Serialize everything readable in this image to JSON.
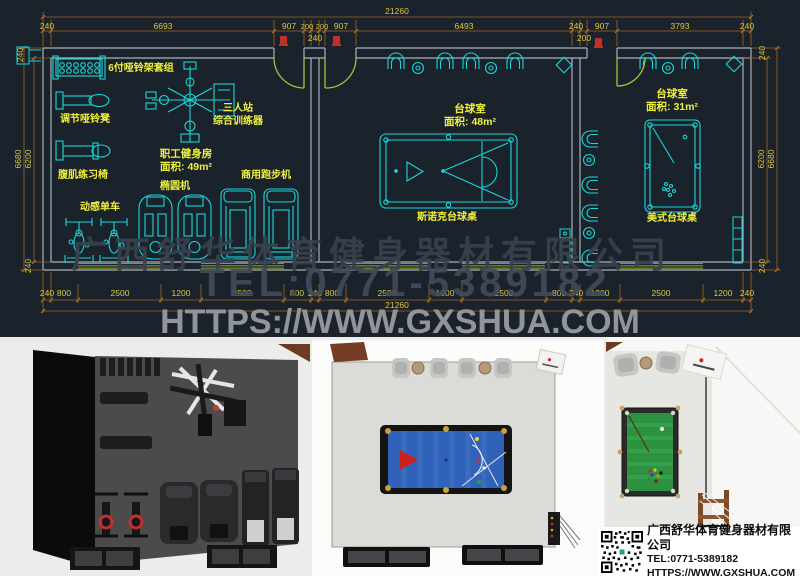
{
  "plan": {
    "colors": {
      "bg": "#1a222c",
      "equipment": "#17d8d8",
      "wall": "#a9b1bb",
      "dim_line": "#a5661f",
      "dim_text": "#dcc93e",
      "label": "#eff03c",
      "door": "#a0c636",
      "window": "#7f9a26",
      "door_tag_red": "#c23028"
    },
    "rooms": [
      {
        "name": "职工健身房",
        "area": "面积: 49m²"
      },
      {
        "name": "台球室",
        "area": "面积: 48m²"
      },
      {
        "name": "台球室",
        "area": "面积: 31m²"
      }
    ],
    "labels": [
      {
        "t": "21260",
        "x": 397,
        "y": 14
      },
      {
        "t": "240",
        "x": 47,
        "y": 29
      },
      {
        "t": "6693",
        "x": 163,
        "y": 29
      },
      {
        "t": "907",
        "x": 289,
        "y": 29
      },
      {
        "t": "200",
        "x": 307,
        "y": 29,
        "fs": 7.5
      },
      {
        "t": "200",
        "x": 322,
        "y": 29,
        "fs": 7.5
      },
      {
        "t": "907",
        "x": 341,
        "y": 29
      },
      {
        "t": "6493",
        "x": 464,
        "y": 29
      },
      {
        "t": "240",
        "x": 576,
        "y": 29
      },
      {
        "t": "907",
        "x": 602,
        "y": 29
      },
      {
        "t": "3793",
        "x": 680,
        "y": 29
      },
      {
        "t": "240",
        "x": 747,
        "y": 29
      },
      {
        "t": "240",
        "x": 315,
        "y": 41
      },
      {
        "t": "200",
        "x": 584,
        "y": 41
      },
      {
        "t": "240",
        "x": 47,
        "y": 296
      },
      {
        "t": "800",
        "x": 64,
        "y": 296
      },
      {
        "t": "2500",
        "x": 120,
        "y": 296
      },
      {
        "t": "1200",
        "x": 181,
        "y": 296
      },
      {
        "t": "2500",
        "x": 242,
        "y": 296
      },
      {
        "t": "800",
        "x": 297,
        "y": 296
      },
      {
        "t": "240",
        "x": 315,
        "y": 296
      },
      {
        "t": "800",
        "x": 332,
        "y": 296
      },
      {
        "t": "2500",
        "x": 387,
        "y": 296
      },
      {
        "t": "1000",
        "x": 445,
        "y": 296
      },
      {
        "t": "2500",
        "x": 504,
        "y": 296
      },
      {
        "t": "800",
        "x": 559,
        "y": 296
      },
      {
        "t": "240",
        "x": 576,
        "y": 296
      },
      {
        "t": "1200",
        "x": 600,
        "y": 296
      },
      {
        "t": "2500",
        "x": 661,
        "y": 296
      },
      {
        "t": "1200",
        "x": 723,
        "y": 296
      },
      {
        "t": "240",
        "x": 747,
        "y": 296
      },
      {
        "t": "21260",
        "x": 397,
        "y": 308
      },
      {
        "t": "240",
        "x": 23,
        "y": 55,
        "rot": -90
      },
      {
        "t": "6680",
        "x": 21,
        "y": 159,
        "rot": -90
      },
      {
        "t": "6200",
        "x": 31,
        "y": 159,
        "rot": -90
      },
      {
        "t": "240",
        "x": 31,
        "y": 266,
        "rot": -90
      },
      {
        "t": "240",
        "x": 765,
        "y": 53,
        "rot": -90
      },
      {
        "t": "6200",
        "x": 764,
        "y": 159,
        "rot": -90
      },
      {
        "t": "6680",
        "x": 774,
        "y": 159,
        "rot": -90
      },
      {
        "t": "240",
        "x": 765,
        "y": 266,
        "rot": -90
      },
      {
        "t": "6付哑铃架套组",
        "x": 141,
        "y": 71,
        "c": "label",
        "fs": 10,
        "b": 1
      },
      {
        "t": "调节哑铃凳",
        "x": 85,
        "y": 122,
        "c": "label",
        "fs": 10,
        "b": 1
      },
      {
        "t": "腹肌练习椅",
        "x": 83,
        "y": 178,
        "c": "label",
        "fs": 10,
        "b": 1
      },
      {
        "t": "动感单车",
        "x": 100,
        "y": 210,
        "c": "label",
        "fs": 10,
        "b": 1
      },
      {
        "t": "椭圆机",
        "x": 175,
        "y": 189,
        "c": "label",
        "fs": 10,
        "b": 1
      },
      {
        "t": "三人站",
        "x": 238,
        "y": 111,
        "c": "label",
        "fs": 10,
        "b": 1
      },
      {
        "t": "综合训练器",
        "x": 238,
        "y": 124,
        "c": "label",
        "fs": 10,
        "b": 1
      },
      {
        "t": "商用跑步机",
        "x": 266,
        "y": 178,
        "c": "label",
        "fs": 10,
        "b": 1
      },
      {
        "t": "职工健身房",
        "x": 186,
        "y": 157,
        "c": "label",
        "fs": 10.5,
        "b": 1
      },
      {
        "t": "面积: 49m²",
        "x": 186,
        "y": 170,
        "c": "label",
        "fs": 10.5,
        "b": 1
      },
      {
        "t": "台球室",
        "x": 470,
        "y": 112,
        "c": "label",
        "fs": 10.5,
        "b": 1
      },
      {
        "t": "面积: 48m²",
        "x": 470,
        "y": 125,
        "c": "label",
        "fs": 10.5,
        "b": 1
      },
      {
        "t": "斯诺克台球桌",
        "x": 447,
        "y": 220,
        "c": "label",
        "fs": 10,
        "b": 1
      },
      {
        "t": "台球室",
        "x": 672,
        "y": 97,
        "c": "label",
        "fs": 10.5,
        "b": 1
      },
      {
        "t": "面积: 31m²",
        "x": 672,
        "y": 110,
        "c": "label",
        "fs": 10.5,
        "b": 1
      },
      {
        "t": "美式台球桌",
        "x": 672,
        "y": 221,
        "c": "label",
        "fs": 10,
        "b": 1
      }
    ]
  },
  "watermark": {
    "company": "广西舒华体育健身器材有限公司",
    "tel": "TEL:0771-5389182",
    "url": "HTTPS://WWW.GXSHUA.COM"
  },
  "infobox": {
    "company": "广西舒华体育健身器材有限公司",
    "tel": "TEL:0771-5389182",
    "url": "HTTPS://WWW.GXSHUA.COM"
  }
}
